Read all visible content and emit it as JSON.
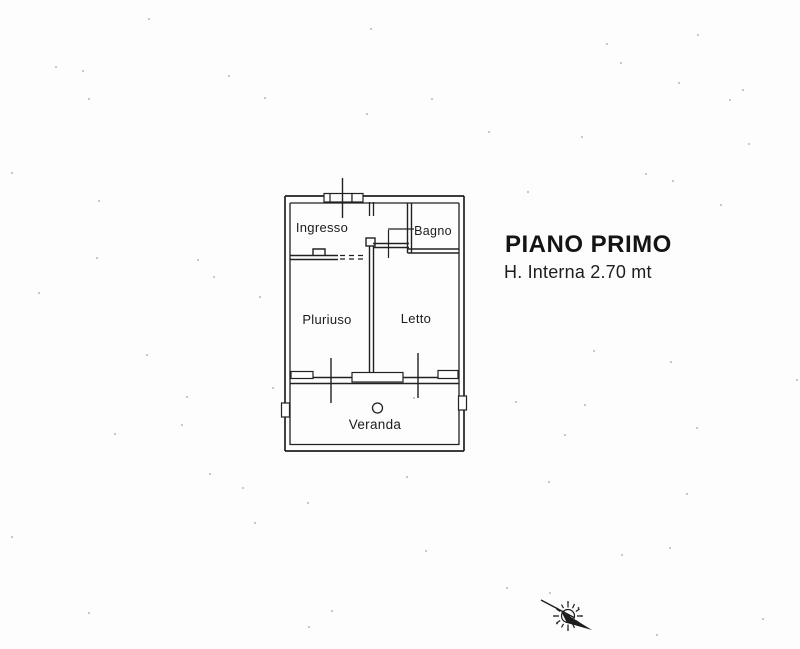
{
  "page": {
    "background": "#fdfdfd",
    "ink": "#212121"
  },
  "annotation": {
    "title": "PIANO PRIMO",
    "subtitle": "H. Interna 2.70 mt"
  },
  "floor_plan": {
    "rooms": [
      {
        "name": "ingresso",
        "label": "Ingresso"
      },
      {
        "name": "bagno",
        "label": "Bagno"
      },
      {
        "name": "pluriuso",
        "label": "Pluriuso"
      },
      {
        "name": "letto",
        "label": "Letto"
      },
      {
        "name": "veranda",
        "label": "Veranda"
      }
    ]
  },
  "compass": {
    "icon": "north-arrow-compass"
  },
  "noise_specks": [
    [
      148,
      18
    ],
    [
      370,
      28
    ],
    [
      697,
      34
    ],
    [
      606,
      43
    ],
    [
      620,
      62
    ],
    [
      55,
      66
    ],
    [
      82,
      70
    ],
    [
      228,
      75
    ],
    [
      678,
      82
    ],
    [
      742,
      89
    ],
    [
      88,
      98
    ],
    [
      264,
      97
    ],
    [
      431,
      98
    ],
    [
      729,
      99
    ],
    [
      366,
      113
    ],
    [
      488,
      131
    ],
    [
      581,
      136
    ],
    [
      748,
      143
    ],
    [
      11,
      172
    ],
    [
      645,
      173
    ],
    [
      672,
      180
    ],
    [
      527,
      191
    ],
    [
      98,
      200
    ],
    [
      720,
      204
    ],
    [
      96,
      257
    ],
    [
      197,
      259
    ],
    [
      213,
      276
    ],
    [
      38,
      292
    ],
    [
      259,
      296
    ],
    [
      796,
      379
    ],
    [
      593,
      350
    ],
    [
      670,
      361
    ],
    [
      146,
      354
    ],
    [
      272,
      387
    ],
    [
      186,
      396
    ],
    [
      515,
      401
    ],
    [
      584,
      404
    ],
    [
      413,
      397
    ],
    [
      181,
      424
    ],
    [
      696,
      427
    ],
    [
      564,
      434
    ],
    [
      114,
      433
    ],
    [
      209,
      473
    ],
    [
      406,
      476
    ],
    [
      548,
      481
    ],
    [
      686,
      493
    ],
    [
      242,
      487
    ],
    [
      307,
      502
    ],
    [
      254,
      522
    ],
    [
      11,
      536
    ],
    [
      425,
      550
    ],
    [
      621,
      554
    ],
    [
      669,
      547
    ],
    [
      88,
      612
    ],
    [
      331,
      610
    ],
    [
      506,
      587
    ],
    [
      308,
      626
    ],
    [
      656,
      634
    ],
    [
      549,
      592
    ],
    [
      762,
      618
    ]
  ]
}
